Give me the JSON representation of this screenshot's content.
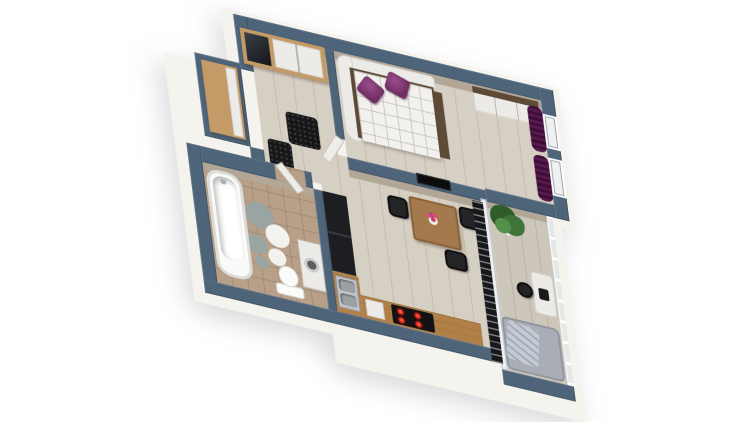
{
  "scene": {
    "type": "3d-floorplan-render",
    "background": "#ffffff",
    "view": "top-down axonometric, rotated clockwise",
    "title": "One-bedroom apartment 3D floor plan"
  },
  "palette": {
    "wall-top": "#4d6479",
    "wall-face": "#b2a697",
    "wall-white": "#f5f3ee",
    "floor-wood": "#d6cfc3",
    "floor-balcony": "#cdc7bb",
    "floor-bath": "#b79f88",
    "wood-oak": "#c49a66",
    "wood-counter": "#b08048",
    "wood-table": "#a5794e",
    "wood-dark": "#5d4a37",
    "furniture-white": "#ecebe7",
    "black-unit": "#1d1e21",
    "mattress": "#f2f1ee",
    "purple": "#702e63",
    "curtain": "#571a4e",
    "sofa-gray": "#a9aeb6",
    "plant-green": "#3e7339",
    "hob-red": "#c32013",
    "steel": "#bfc3c7",
    "rug-black": "#17171a",
    "door-white": "#efede8"
  },
  "rooms": [
    {
      "id": "hallway",
      "label": "Entry hallway",
      "furniture": [
        "wardrobe-with-mirror",
        "oak-side-cabinet",
        "black-doormat",
        "black-rug"
      ]
    },
    {
      "id": "bedroom",
      "label": "Bedroom",
      "furniture": [
        "corner-bed-white-quilted",
        "purple-pillow",
        "purple-pillow",
        "white-wardrobe-wood-top",
        "purple-curtains",
        "windows"
      ]
    },
    {
      "id": "living-kitchen",
      "label": "Living room / kitchen",
      "furniture": [
        "wall-tv",
        "dining-table",
        "black-chairs",
        "flower-vase",
        "black-tall-cabinets",
        "wood-countertop",
        "steel-sink",
        "induction-hob",
        "balcony-glazing-blinds"
      ]
    },
    {
      "id": "bathroom",
      "label": "Bathroom",
      "furniture": [
        "bathtub",
        "toilet",
        "washing-machine",
        "circle-pattern-rug",
        "white-door"
      ]
    },
    {
      "id": "balcony",
      "label": "Balcony",
      "furniture": [
        "potted-plant",
        "small-desk",
        "black-chair",
        "gray-sofa-with-blanket",
        "glass-railing"
      ]
    }
  ]
}
